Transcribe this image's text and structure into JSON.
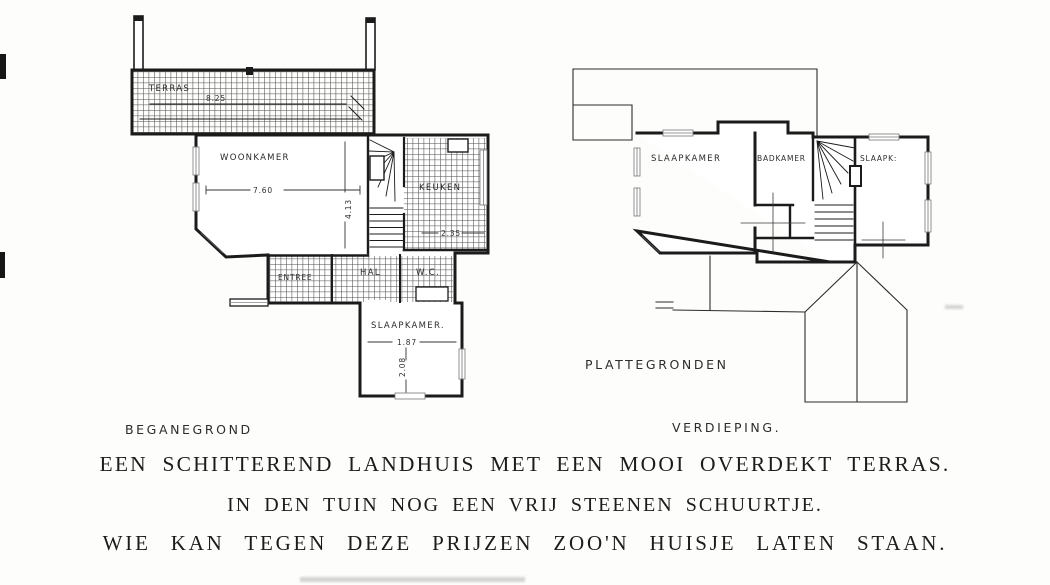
{
  "ground_floor": {
    "label": "BEGANEGROND",
    "rooms": {
      "terras": "TERRAS",
      "woonkamer": "WOONKAMER",
      "keuken": "KEUKEN",
      "entree": "ENTREE",
      "hal": "HAL",
      "wc": "W.C.",
      "slaapkamer": "SLAAPKAMER."
    },
    "dimensions": {
      "terras_width": "8.25",
      "woonkamer_width": "7.60",
      "woonkamer_depth": "4.13",
      "keuken_width": "2.35",
      "slaapkamer_width": "1.87",
      "slaapkamer_depth": "2.08"
    }
  },
  "upper_floor": {
    "label": "VERDIEPING.",
    "rooms": {
      "slaapkamer": "SLAAPKAMER",
      "badkamer": "BADKAMER",
      "slaapk": "SLAAPK:"
    }
  },
  "plans_label": "PLATTEGRONDEN",
  "caption": {
    "line1": "EEN SCHITTEREND LANDHUIS MET EEN MOOI OVERDEKT TERRAS.",
    "line2": "IN DEN TUIN NOG EEN VRIJ STEENEN SCHUURTJE.",
    "line3": "WIE KAN TEGEN DEZE PRIJZEN ZOO'N HUISJE LATEN STAAN."
  },
  "colors": {
    "ink": "#1b1b1b",
    "paper": "#fdfdfb"
  }
}
